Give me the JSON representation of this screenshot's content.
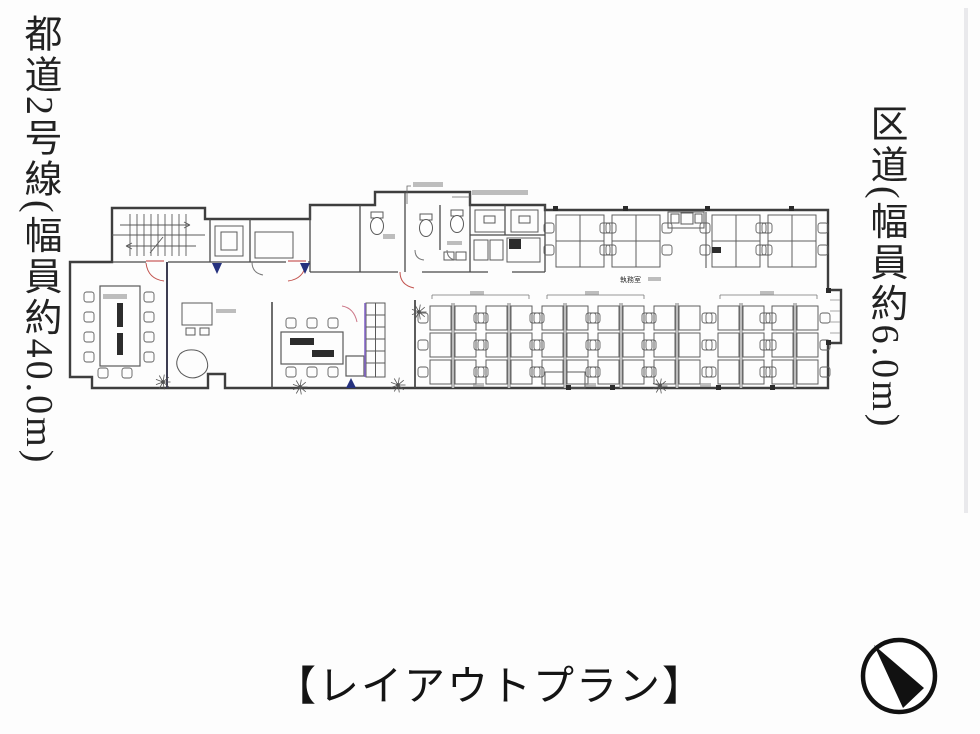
{
  "title_caption": "【レイアウトプラン】",
  "roads": {
    "left": "都道2号線(幅員約40.0m)",
    "right": "区道(幅員約6.0m)"
  },
  "plan": {
    "labels": {
      "office": "執務室"
    }
  },
  "icons": {
    "north_arrow": "north-arrow-icon"
  },
  "colors": {
    "wall": "#474747",
    "door_red": "#c2524d",
    "partition_purple": "#8668c9",
    "entry_navy": "#25317e",
    "ink": "#1c1c1c"
  }
}
